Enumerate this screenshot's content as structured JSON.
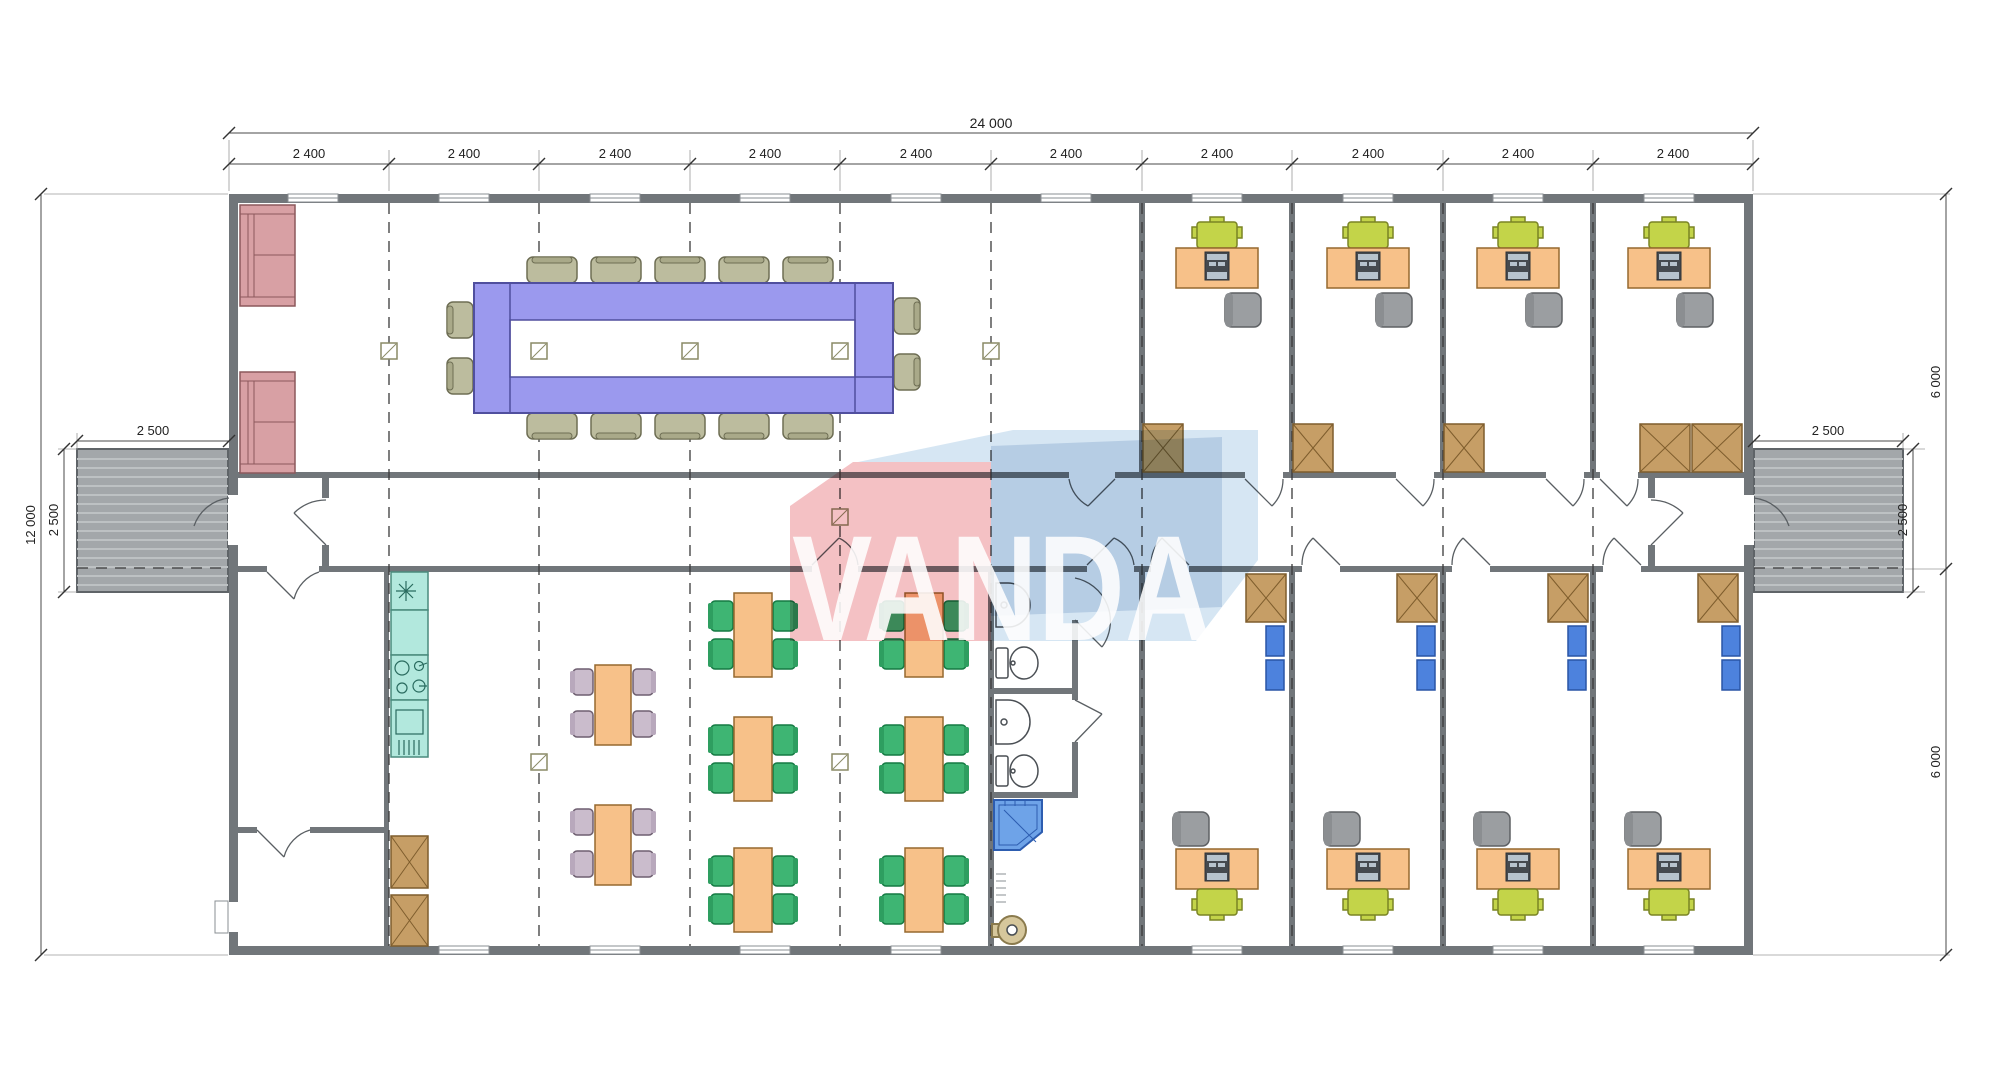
{
  "watermark": {
    "text": "VANDA",
    "pink": "#f2b6ba",
    "blue": "#a9c4e0",
    "light_blue": "#cfe2f1"
  },
  "dimensions": {
    "top_total": "24 000",
    "top_modules": [
      "2 400",
      "2 400",
      "2 400",
      "2 400",
      "2 400",
      "2 400",
      "2 400",
      "2 400",
      "2 400",
      "2 400"
    ],
    "left_height": "12 000",
    "left_ramp_width": "2 500",
    "left_ramp_depth": "2 500",
    "right_ramp_width": "2 500",
    "right_ramp_depth": "2 500",
    "right_upper_height": "6 000",
    "right_lower_height": "6 000"
  },
  "colors": {
    "wall": "#71767a",
    "ramp": "#a3a7aa",
    "conference_table": "#9b99ee",
    "conference_chair": "#bcbc9e",
    "sofa": "#d8a0a4",
    "desk": "#f7c189",
    "task_chair": "#c3d449",
    "guest_chair": "#9b9ea1",
    "wardrobe": "#c69e66",
    "locker": "#4d82dd",
    "kitchen_unit": "#b2e8dd",
    "dining_chair": "#cabccc",
    "canteen_chair": "#3eb573",
    "shower": "#6ea3e8",
    "water_heater": "#d6c79c"
  }
}
